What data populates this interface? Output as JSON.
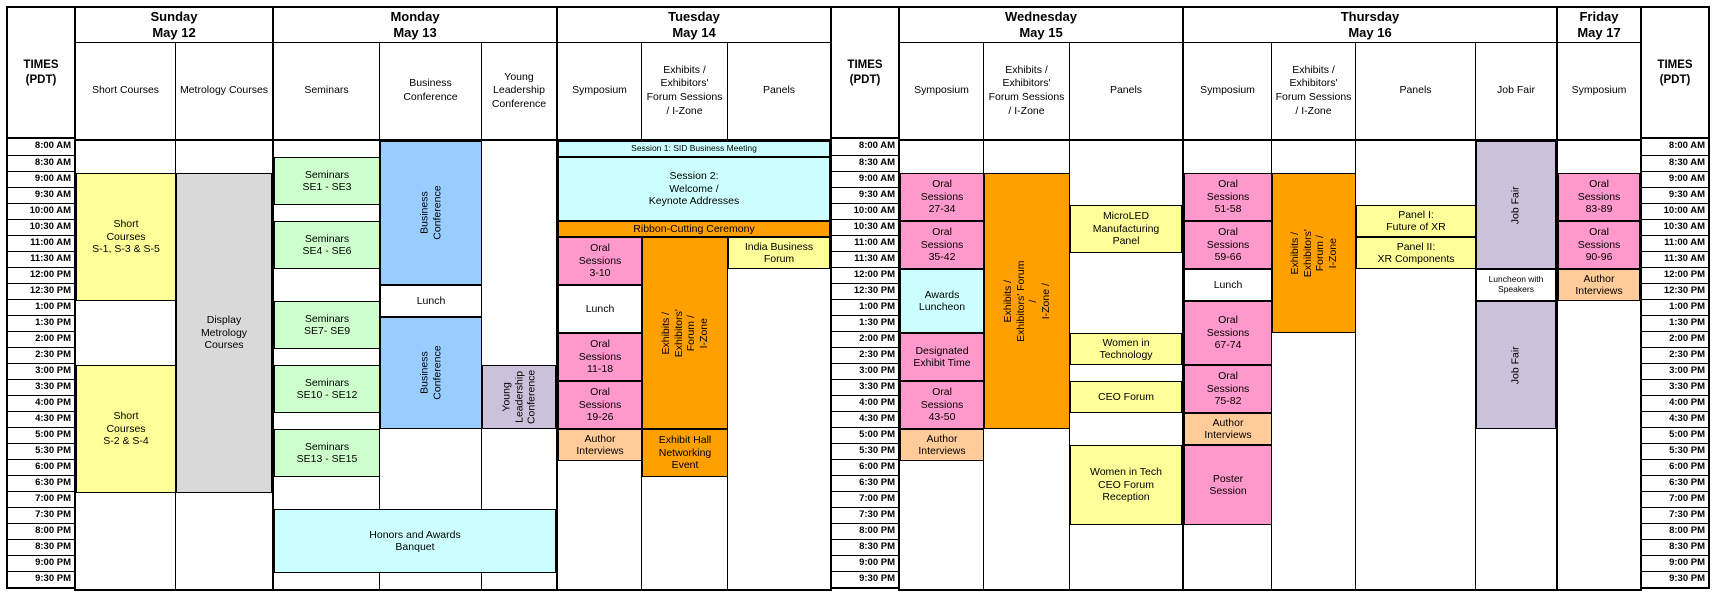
{
  "times_label": "TIMES\n(PDT)",
  "time_slots": [
    "8:00 AM",
    "8:30 AM",
    "9:00 AM",
    "9:30 AM",
    "10:00 AM",
    "10:30 AM",
    "11:00 AM",
    "11:30 AM",
    "12:00 PM",
    "12:30 PM",
    "1:00 PM",
    "1:30 PM",
    "2:00 PM",
    "2:30 PM",
    "3:00 PM",
    "3:30 PM",
    "4:00 PM",
    "4:30 PM",
    "5:00 PM",
    "5:30 PM",
    "6:00 PM",
    "6:30 PM",
    "7:00 PM",
    "7:30 PM",
    "8:00 PM",
    "8:30 PM",
    "9:00 PM",
    "9:30 PM"
  ],
  "colors": {
    "yellow": "#FFFF99",
    "green": "#CCFFCC",
    "blue": "#99CCFF",
    "purple": "#CCC1DA",
    "cyan": "#CCFFFF",
    "pink": "#FF99CC",
    "orange": "#FF9F00",
    "peach": "#FFCC99",
    "gray": "#D9D9D9",
    "white": "#FFFFFF"
  },
  "days": [
    {
      "name": "Sunday",
      "date": "May 12",
      "columns": [
        {
          "label": "Short Courses"
        },
        {
          "label": "Metrology Courses"
        }
      ],
      "blocks": [
        {
          "name": "short-courses-s1-s3-s5",
          "label": "Short\nCourses\nS-1, S-3 & S-5",
          "col": 1,
          "span": 1,
          "r1": 3,
          "r2": 10,
          "color": "yellow"
        },
        {
          "name": "display-metrology-courses",
          "label": "Display\nMetrology\nCourses",
          "col": 2,
          "span": 1,
          "r1": 3,
          "r2": 22,
          "color": "gray"
        },
        {
          "name": "short-courses-s2-s4",
          "label": "Short\nCourses\nS-2 & S-4",
          "col": 1,
          "span": 1,
          "r1": 15,
          "r2": 22,
          "color": "yellow"
        }
      ]
    },
    {
      "name": "Monday",
      "date": "May 13",
      "columns": [
        {
          "label": "Seminars"
        },
        {
          "label": "Business Conference"
        },
        {
          "label": "Young Leadership Conference"
        }
      ],
      "blocks": [
        {
          "name": "seminars-se1-se3",
          "label": "Seminars\nSE1 - SE3",
          "col": 1,
          "span": 1,
          "r1": 2,
          "r2": 4,
          "color": "green"
        },
        {
          "name": "seminars-se4-se6",
          "label": "Seminars\nSE4 - SE6",
          "col": 1,
          "span": 1,
          "r1": 6,
          "r2": 8,
          "color": "green"
        },
        {
          "name": "seminars-se7-se9",
          "label": "Seminars\nSE7- SE9",
          "col": 1,
          "span": 1,
          "r1": 11,
          "r2": 13,
          "color": "green"
        },
        {
          "name": "seminars-se10-se12",
          "label": "Seminars\nSE10 - SE12",
          "col": 1,
          "span": 1,
          "r1": 15,
          "r2": 17,
          "color": "green"
        },
        {
          "name": "seminars-se13-se15",
          "label": "Seminars\nSE13 - SE15",
          "col": 1,
          "span": 1,
          "r1": 19,
          "r2": 21,
          "color": "green"
        },
        {
          "name": "business-conference-morning",
          "label": "Business\nConference",
          "col": 2,
          "span": 1,
          "r1": 1,
          "r2": 9,
          "color": "blue",
          "vertical": true
        },
        {
          "name": "lunch-monday",
          "label": "Lunch",
          "col": 2,
          "span": 1,
          "r1": 10,
          "r2": 11,
          "color": "white"
        },
        {
          "name": "business-conference-afternoon",
          "label": "Business\nConference",
          "col": 2,
          "span": 1,
          "r1": 12,
          "r2": 18,
          "color": "blue",
          "vertical": true
        },
        {
          "name": "young-leadership-conference",
          "label": "Young\nLeadership\nConference",
          "col": 3,
          "span": 1,
          "r1": 15,
          "r2": 18,
          "color": "purple",
          "vertical": true
        },
        {
          "name": "honors-awards-banquet",
          "label": "Honors and Awards\nBanquet",
          "col": 1,
          "span": 3,
          "r1": 24,
          "r2": 27,
          "color": "cyan"
        }
      ]
    },
    {
      "name": "Tuesday",
      "date": "May 14",
      "columns": [
        {
          "label": "Symposium"
        },
        {
          "label": "Exhibits / Exhibitors' Forum Sessions / I-Zone"
        },
        {
          "label": "Panels"
        }
      ],
      "blocks": [
        {
          "name": "session-1-sid-business-meeting",
          "label": "Session 1:  SID Business Meeting",
          "col": 1,
          "span": 3,
          "r1": 1,
          "r2": 1,
          "color": "cyan",
          "small": true
        },
        {
          "name": "session-2-welcome-keynotes",
          "label": "Session 2:\nWelcome /\nKeynote Addresses",
          "col": 1,
          "span": 3,
          "r1": 2,
          "r2": 5,
          "color": "cyan"
        },
        {
          "name": "ribbon-cutting-ceremony",
          "label": "Ribbon-Cutting Ceremony",
          "col": 1,
          "span": 3,
          "r1": 6,
          "r2": 6,
          "color": "orange"
        },
        {
          "name": "oral-sessions-3-10",
          "label": "Oral\nSessions\n3-10",
          "col": 1,
          "span": 1,
          "r1": 7,
          "r2": 9,
          "color": "pink"
        },
        {
          "name": "lunch-tuesday",
          "label": "Lunch",
          "col": 1,
          "span": 1,
          "r1": 10,
          "r2": 12,
          "color": "white"
        },
        {
          "name": "oral-sessions-11-18",
          "label": "Oral\nSessions\n11-18",
          "col": 1,
          "span": 1,
          "r1": 13,
          "r2": 15,
          "color": "pink"
        },
        {
          "name": "oral-sessions-19-26",
          "label": "Oral\nSessions\n19-26",
          "col": 1,
          "span": 1,
          "r1": 16,
          "r2": 18,
          "color": "pink"
        },
        {
          "name": "author-interviews-tuesday",
          "label": "Author\nInterviews",
          "col": 1,
          "span": 1,
          "r1": 19,
          "r2": 20,
          "color": "peach"
        },
        {
          "name": "exhibits-forum-izone-tuesday",
          "label": "Exhibits / Exhibitors'\nForum /\nI-Zone",
          "col": 2,
          "span": 1,
          "r1": 7,
          "r2": 18,
          "color": "orange",
          "vertical": true
        },
        {
          "name": "exhibit-hall-networking-event",
          "label": "Exhibit Hall\nNetworking\nEvent",
          "col": 2,
          "span": 1,
          "r1": 19,
          "r2": 21,
          "color": "orange"
        },
        {
          "name": "india-business-forum",
          "label": "India Business\nForum",
          "col": 3,
          "span": 1,
          "r1": 7,
          "r2": 8,
          "color": "yellow"
        }
      ]
    },
    {
      "name": "Wednesday",
      "date": "May 15",
      "columns": [
        {
          "label": "Symposium"
        },
        {
          "label": "Exhibits / Exhibitors' Forum Sessions / I-Zone"
        },
        {
          "label": "Panels"
        }
      ],
      "blocks": [
        {
          "name": "oral-sessions-27-34",
          "label": "Oral\nSessions\n27-34",
          "col": 1,
          "span": 1,
          "r1": 3,
          "r2": 5,
          "color": "pink"
        },
        {
          "name": "oral-sessions-35-42",
          "label": "Oral\nSessions\n35-42",
          "col": 1,
          "span": 1,
          "r1": 6,
          "r2": 8,
          "color": "pink"
        },
        {
          "name": "awards-luncheon",
          "label": "Awards\nLuncheon",
          "col": 1,
          "span": 1,
          "r1": 9,
          "r2": 12,
          "color": "cyan",
          "small": false
        },
        {
          "name": "designated-exhibit-time",
          "label": "Designated\nExhibit Time",
          "col": 1,
          "span": 1,
          "r1": 13,
          "r2": 15,
          "color": "pink"
        },
        {
          "name": "oral-sessions-43-50",
          "label": "Oral\nSessions\n43-50",
          "col": 1,
          "span": 1,
          "r1": 16,
          "r2": 18,
          "color": "pink"
        },
        {
          "name": "author-interviews-wednesday",
          "label": "Author\nInterviews",
          "col": 1,
          "span": 1,
          "r1": 19,
          "r2": 20,
          "color": "peach"
        },
        {
          "name": "exhibits-forum-izone-wednesday",
          "label": "Exhibits / Exhibitors' Forum /\nI-Zone /",
          "col": 2,
          "span": 1,
          "r1": 3,
          "r2": 18,
          "color": "orange",
          "vertical": true
        },
        {
          "name": "microled-manufacturing-panel",
          "label": "MicroLED\nManufacturing\nPanel",
          "col": 3,
          "span": 1,
          "r1": 5,
          "r2": 7,
          "color": "yellow"
        },
        {
          "name": "women-in-technology",
          "label": "Women in\nTechnology",
          "col": 3,
          "span": 1,
          "r1": 13,
          "r2": 14,
          "color": "yellow"
        },
        {
          "name": "ceo-forum",
          "label": "CEO Forum",
          "col": 3,
          "span": 1,
          "r1": 16,
          "r2": 17,
          "color": "yellow"
        },
        {
          "name": "women-in-tech-ceo-forum-reception",
          "label": "Women in Tech\nCEO Forum\nReception",
          "col": 3,
          "span": 1,
          "r1": 20,
          "r2": 24,
          "color": "yellow",
          "small": false
        }
      ]
    },
    {
      "name": "Thursday",
      "date": "May 16",
      "columns": [
        {
          "label": "Symposium"
        },
        {
          "label": "Exhibits / Exhibitors' Forum Sessions / I-Zone"
        },
        {
          "label": "Panels"
        },
        {
          "label": "Job Fair"
        }
      ],
      "blocks": [
        {
          "name": "oral-sessions-51-58",
          "label": "Oral\nSessions\n51-58",
          "col": 1,
          "span": 1,
          "r1": 3,
          "r2": 5,
          "color": "pink"
        },
        {
          "name": "oral-sessions-59-66",
          "label": "Oral\nSessions\n59-66",
          "col": 1,
          "span": 1,
          "r1": 6,
          "r2": 8,
          "color": "pink"
        },
        {
          "name": "lunch-thursday",
          "label": "Lunch",
          "col": 1,
          "span": 1,
          "r1": 9,
          "r2": 10,
          "color": "white"
        },
        {
          "name": "oral-sessions-67-74",
          "label": "Oral\nSessions\n67-74",
          "col": 1,
          "span": 1,
          "r1": 11,
          "r2": 14,
          "color": "pink"
        },
        {
          "name": "oral-sessions-75-82",
          "label": "Oral\nSessions\n75-82",
          "col": 1,
          "span": 1,
          "r1": 15,
          "r2": 17,
          "color": "pink"
        },
        {
          "name": "author-interviews-thursday",
          "label": "Author\nInterviews",
          "col": 1,
          "span": 1,
          "r1": 18,
          "r2": 19,
          "color": "peach"
        },
        {
          "name": "poster-session",
          "label": "Poster\nSession",
          "col": 1,
          "span": 1,
          "r1": 20,
          "r2": 24,
          "color": "pink"
        },
        {
          "name": "exhibits-forum-izone-thursday",
          "label": "Exhibits /\nExhibitors' Forum /\nI-Zone",
          "col": 2,
          "span": 1,
          "r1": 3,
          "r2": 12,
          "color": "orange",
          "vertical": true
        },
        {
          "name": "panel-1-future-of-xr",
          "label": "Panel I:\nFuture of XR",
          "col": 3,
          "span": 1,
          "r1": 5,
          "r2": 6,
          "color": "yellow"
        },
        {
          "name": "panel-2-xr-components",
          "label": "Panel II:\nXR Components",
          "col": 3,
          "span": 1,
          "r1": 7,
          "r2": 8,
          "color": "yellow"
        },
        {
          "name": "job-fair-morning",
          "label": "Job Fair",
          "col": 4,
          "span": 1,
          "r1": 1,
          "r2": 8,
          "color": "purple",
          "vertical": true
        },
        {
          "name": "luncheon-with-speakers",
          "label": "Luncheon with\nSpeakers",
          "col": 4,
          "span": 1,
          "r1": 9,
          "r2": 10,
          "color": "white",
          "small": true
        },
        {
          "name": "job-fair-afternoon",
          "label": "Job Fair",
          "col": 4,
          "span": 1,
          "r1": 11,
          "r2": 18,
          "color": "purple",
          "vertical": true
        }
      ]
    },
    {
      "name": "Friday",
      "date": "May 17",
      "columns": [
        {
          "label": "Symposium"
        }
      ],
      "blocks": [
        {
          "name": "oral-sessions-83-89",
          "label": "Oral\nSessions\n83-89",
          "col": 1,
          "span": 1,
          "r1": 3,
          "r2": 5,
          "color": "pink"
        },
        {
          "name": "oral-sessions-90-96",
          "label": "Oral\nSessions\n90-96",
          "col": 1,
          "span": 1,
          "r1": 6,
          "r2": 8,
          "color": "pink"
        },
        {
          "name": "author-interviews-friday",
          "label": "Author\nInterviews",
          "col": 1,
          "span": 1,
          "r1": 9,
          "r2": 10,
          "color": "peach"
        }
      ]
    }
  ]
}
